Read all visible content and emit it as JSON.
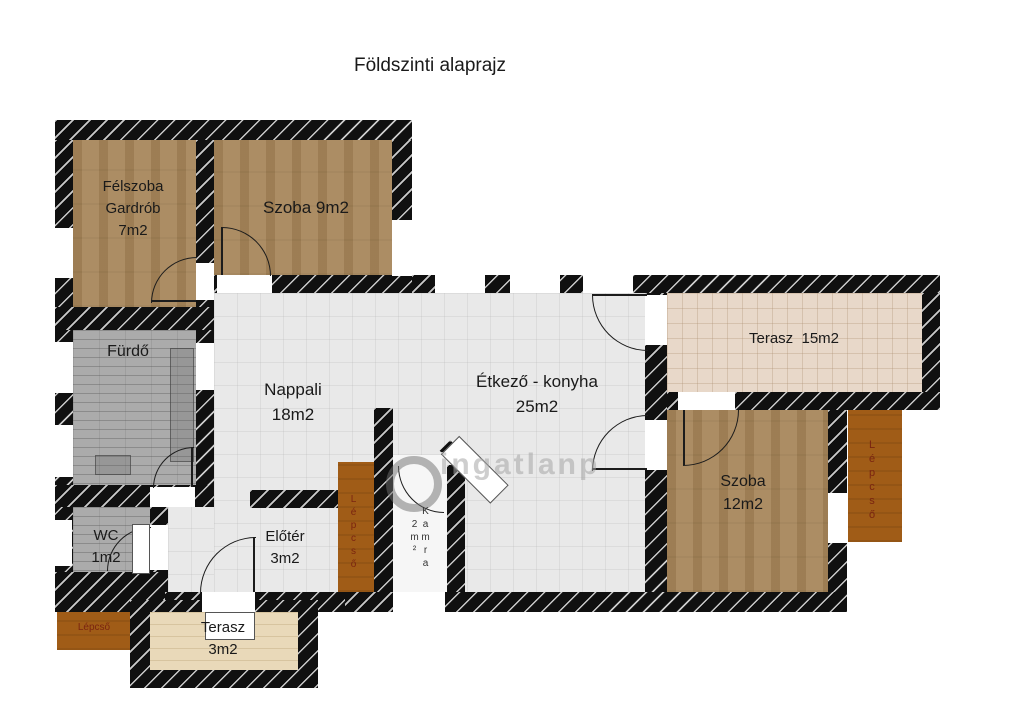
{
  "title": "Földszinti alaprajz",
  "watermark": {
    "text": "ingatlanp"
  },
  "rooms": {
    "felszoba": {
      "name": "Félszoba",
      "name2": "Gardrób",
      "area": "7m2"
    },
    "szoba9": {
      "label": "Szoba 9m2"
    },
    "furdo": {
      "label": "Fürdő"
    },
    "wc": {
      "name": "WC",
      "area": "1m2"
    },
    "nappali": {
      "name": "Nappali",
      "area": "18m2"
    },
    "etkezo": {
      "name": "Étkező - konyha",
      "area": "25m2"
    },
    "eloter": {
      "name": "Előtér",
      "area": "3m2"
    },
    "terasz15": {
      "label": "Terasz  15m2"
    },
    "szoba12": {
      "name": "Szoba",
      "area": "12m2"
    },
    "terasz3": {
      "name": "Terasz",
      "area": "3m2"
    },
    "kamra": {
      "name": "Kamra",
      "area": "2m²"
    }
  },
  "stairs": {
    "bottom_left": {
      "label": "Lépcső"
    },
    "middle": {
      "label": "Lépcső"
    },
    "right": {
      "label": "Lépcső"
    }
  },
  "colors": {
    "wall": "#101010",
    "hatch_line": "#f5f5f5",
    "wood_floor": "#a8875c",
    "tile_gray": "#ababab",
    "floor_light": "#e9e9e9",
    "terrace_large": "#e8d8c9",
    "terrace_small": "#e9d9b9",
    "stairs_fill": "#a05c17",
    "stairs_text": "#7a2410",
    "door_line": "#1c1c1c"
  }
}
